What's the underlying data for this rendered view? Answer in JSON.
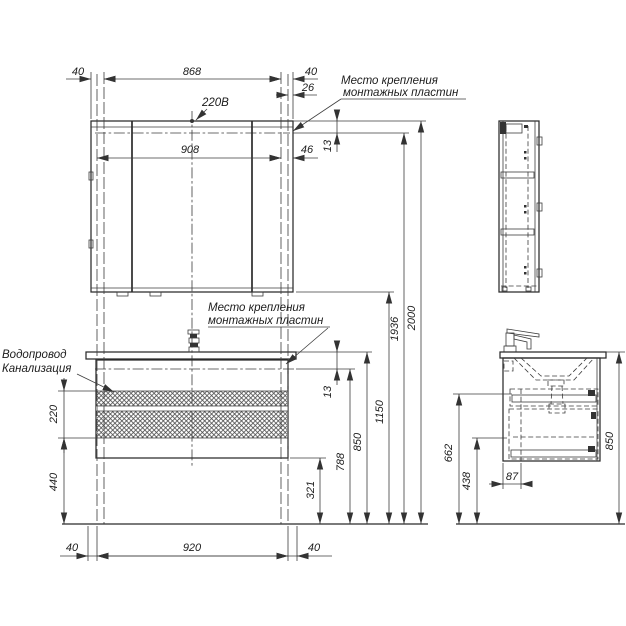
{
  "labels": {
    "power": "220В",
    "mount_top_1": "Место крепления",
    "mount_top_2": "монтажных пластин",
    "mount_mid_1": "Место крепления",
    "mount_mid_2": "монтажных пластин",
    "water": "Водопровод",
    "sewer": "Канализация"
  },
  "dims": {
    "top_left_40": "40",
    "top_868": "868",
    "top_right_40": "40",
    "top_26": "26",
    "mid_908": "908",
    "mid_46": "46",
    "top_13": "13",
    "mid_13": "13",
    "r_321": "321",
    "r_788": "788",
    "r_850": "850",
    "r_1150": "1150",
    "r_1936": "1936",
    "r_2000": "2000",
    "l_220": "220",
    "l_440": "440",
    "b_left_40": "40",
    "b_920": "920",
    "b_right_40": "40",
    "s_662": "662",
    "s_438": "438",
    "s_87": "87",
    "s_850": "850"
  },
  "colors": {
    "line": "#333333",
    "background": "#ffffff"
  }
}
